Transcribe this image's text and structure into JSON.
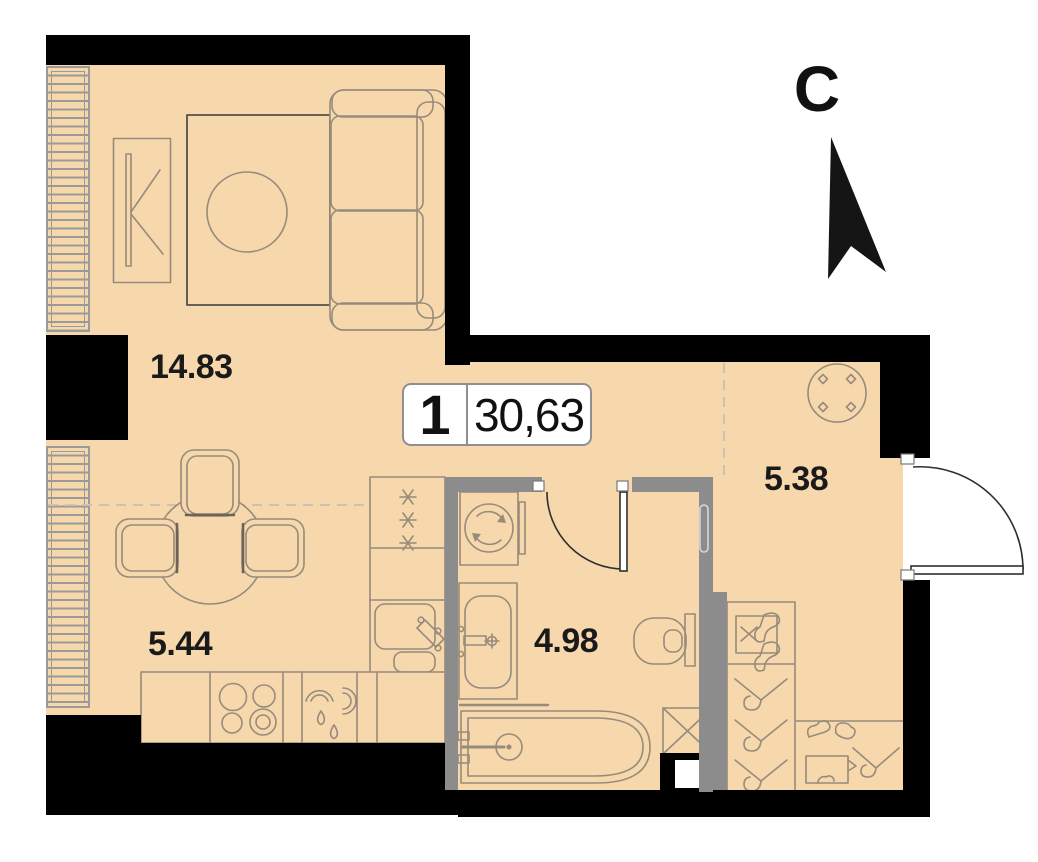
{
  "north": {
    "label": "С"
  },
  "unit": {
    "number": "1",
    "total_area": "30,63"
  },
  "rooms": {
    "living": {
      "area": "14.83"
    },
    "kitchen": {
      "area": "5.44"
    },
    "bathroom": {
      "area": "4.98"
    },
    "hallway": {
      "area": "5.38"
    }
  },
  "theme": {
    "floor": "#F6D8AC",
    "wall": "#000000",
    "partition": "#8C8C8C",
    "furniture_line": "#978B7B",
    "rug_line": "#55504A",
    "dashed_line": "#CCC2AF",
    "door_line": "#2F2F2F",
    "label_color": "#1A1A1A"
  }
}
